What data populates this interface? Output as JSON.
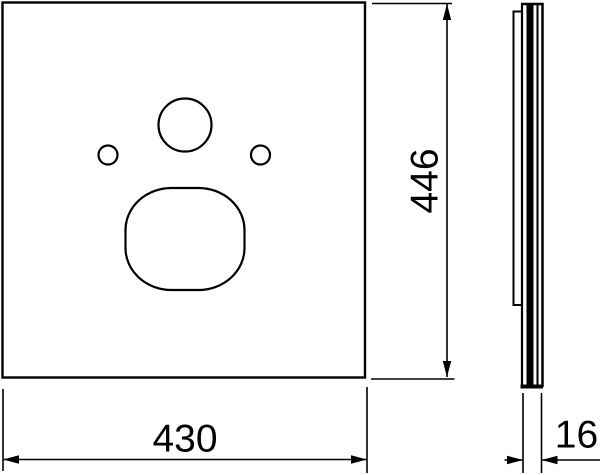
{
  "drawing": {
    "background": "#ffffff",
    "line_color": "#000000",
    "labels": {
      "width": "430",
      "height": "446",
      "thickness": "16"
    }
  }
}
